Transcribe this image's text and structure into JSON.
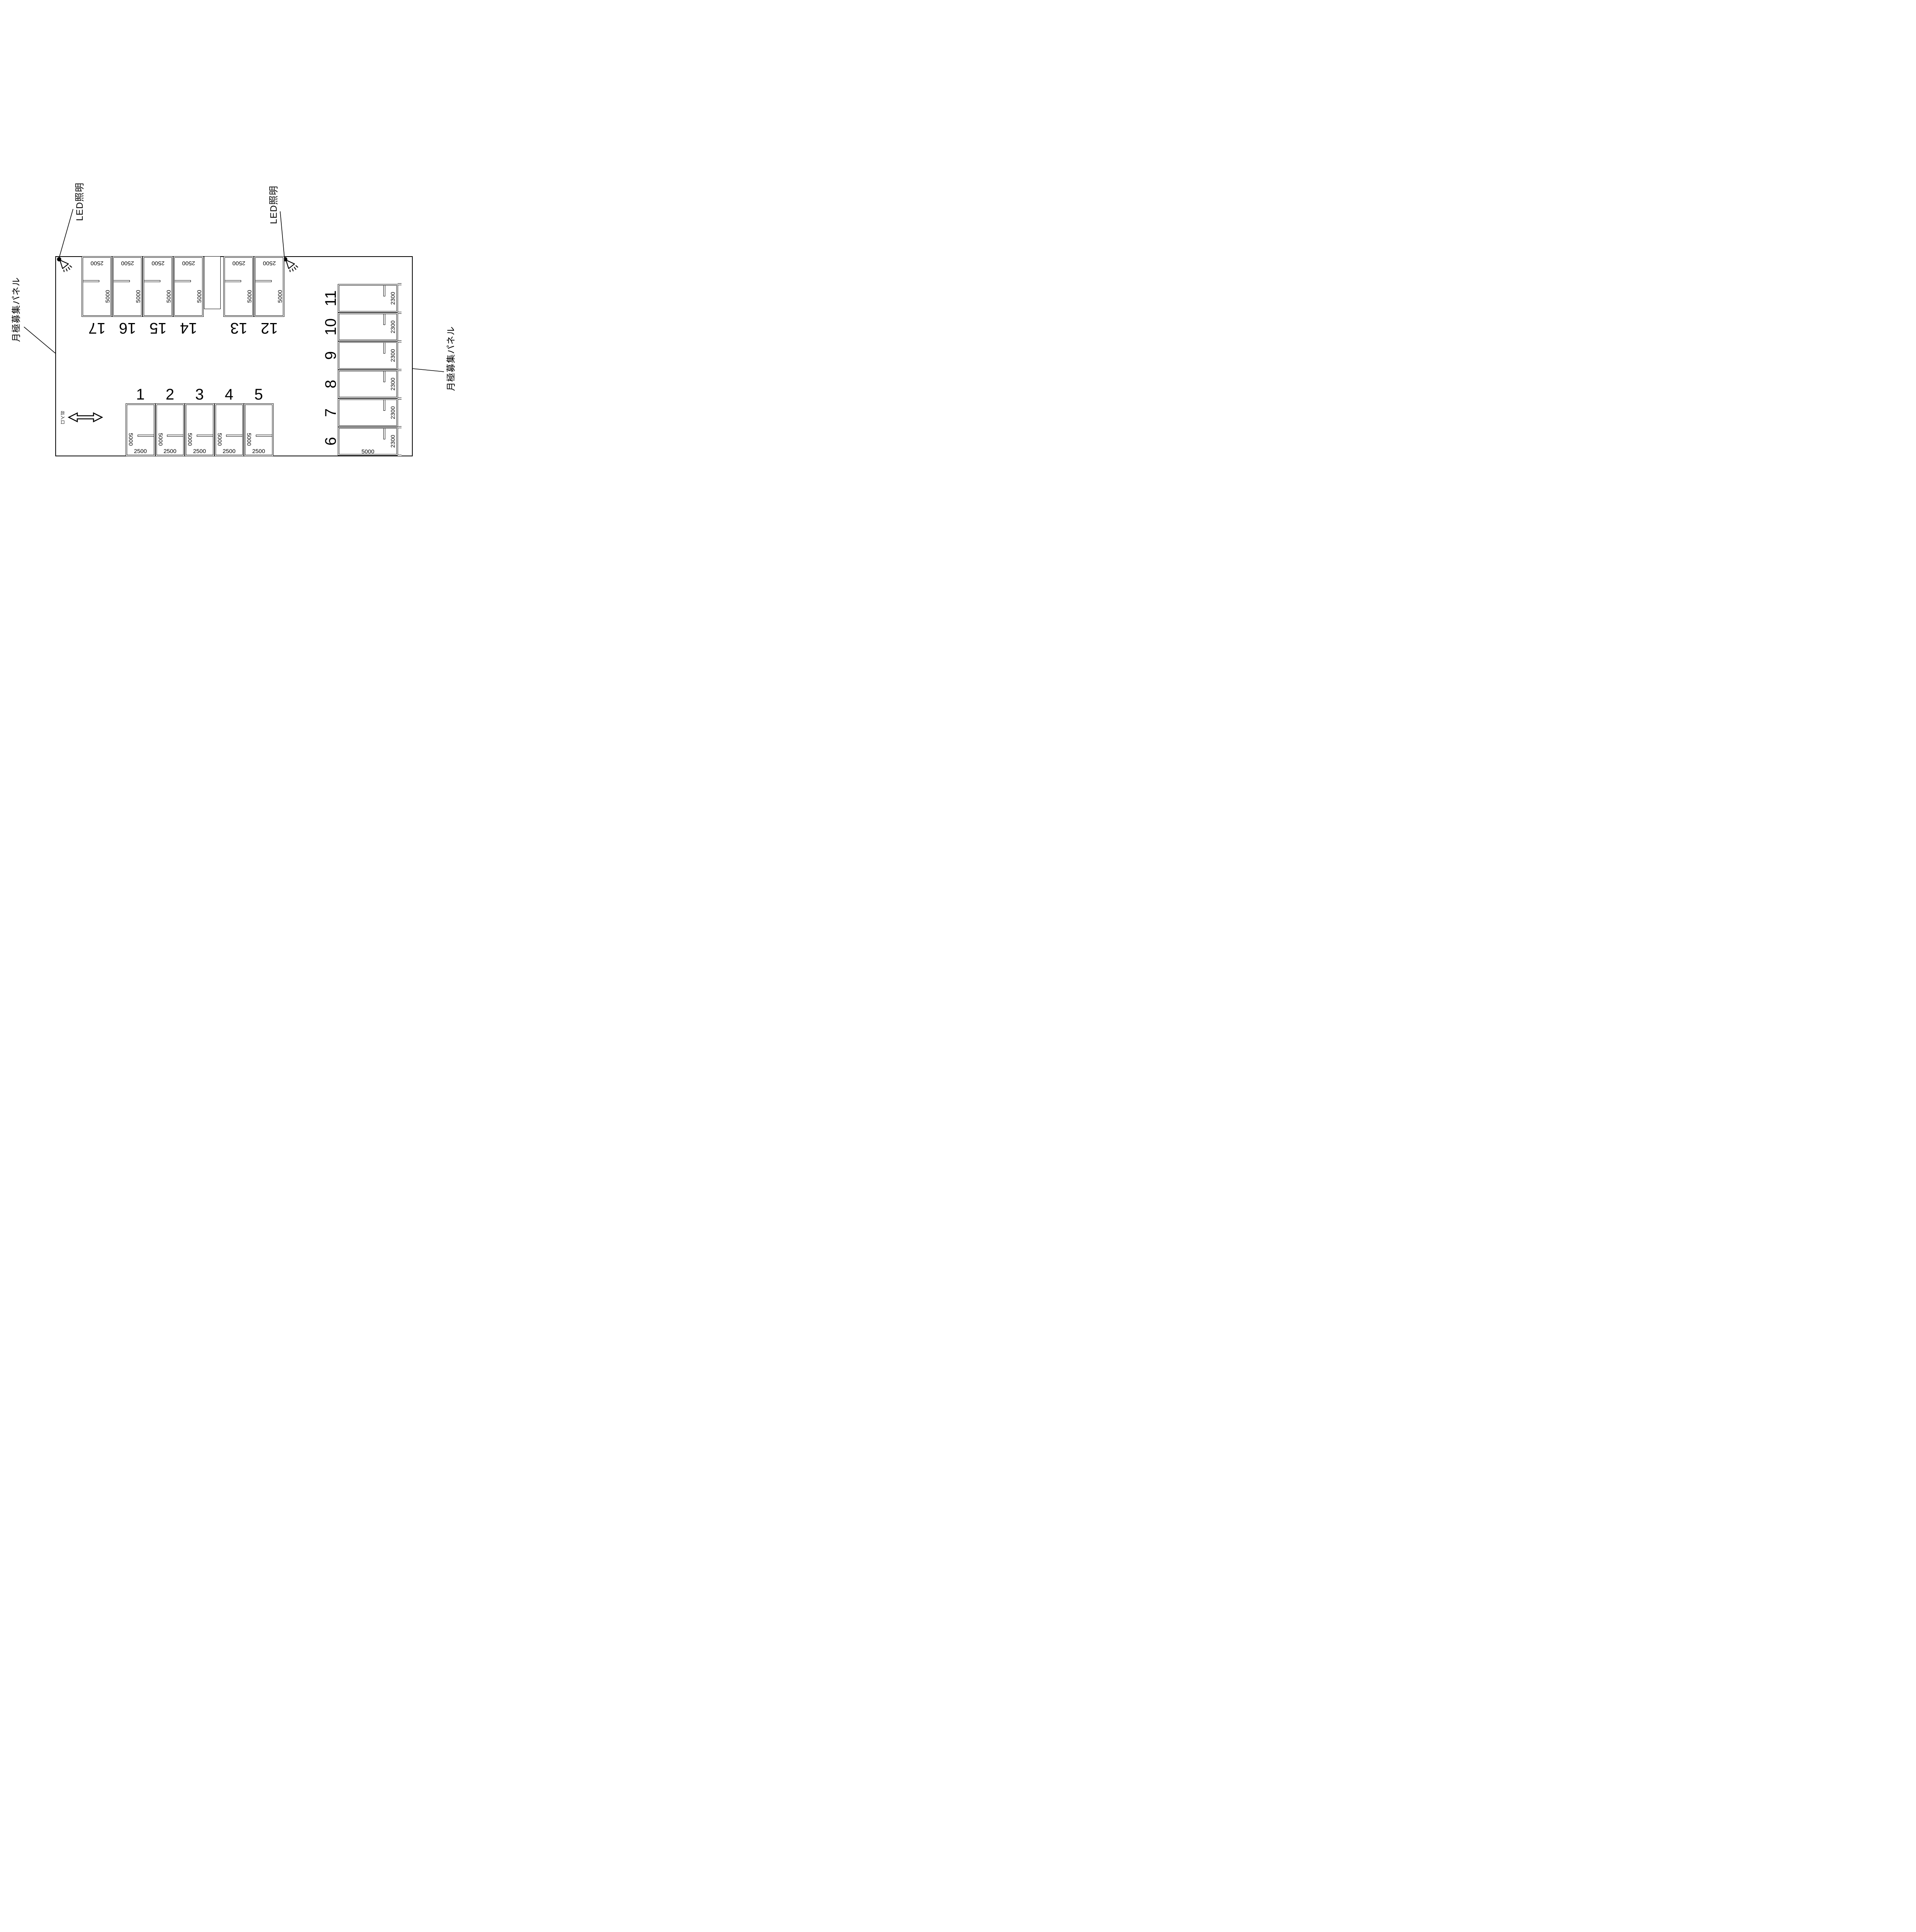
{
  "drawing": {
    "labels": {
      "led": "LED照明",
      "panel": "月極募集パネル",
      "entrance": "出入口"
    },
    "top_row": {
      "stalls": [
        {
          "no": "17",
          "width": "2500",
          "depth": "5000"
        },
        {
          "no": "16",
          "width": "2500",
          "depth": "5000"
        },
        {
          "no": "15",
          "width": "2500",
          "depth": "5000"
        },
        {
          "no": "14",
          "width": "2500",
          "depth": "5000"
        },
        {
          "no": "13",
          "width": "2500",
          "depth": "5000"
        },
        {
          "no": "12",
          "width": "2500",
          "depth": "5000"
        }
      ]
    },
    "bottom_row": {
      "stalls": [
        {
          "no": "1",
          "width": "2500",
          "depth": "5000"
        },
        {
          "no": "2",
          "width": "2500",
          "depth": "5000"
        },
        {
          "no": "3",
          "width": "2500",
          "depth": "5000"
        },
        {
          "no": "4",
          "width": "2500",
          "depth": "5000"
        },
        {
          "no": "5",
          "width": "2500",
          "depth": "5000"
        }
      ]
    },
    "right_column": {
      "stalls": [
        {
          "no": "11",
          "width": "2300"
        },
        {
          "no": "10",
          "width": "2300"
        },
        {
          "no": "9",
          "width": "2300"
        },
        {
          "no": "8",
          "width": "2300"
        },
        {
          "no": "7",
          "width": "2300"
        },
        {
          "no": "6",
          "width": "2300",
          "length": "5000"
        }
      ]
    }
  }
}
